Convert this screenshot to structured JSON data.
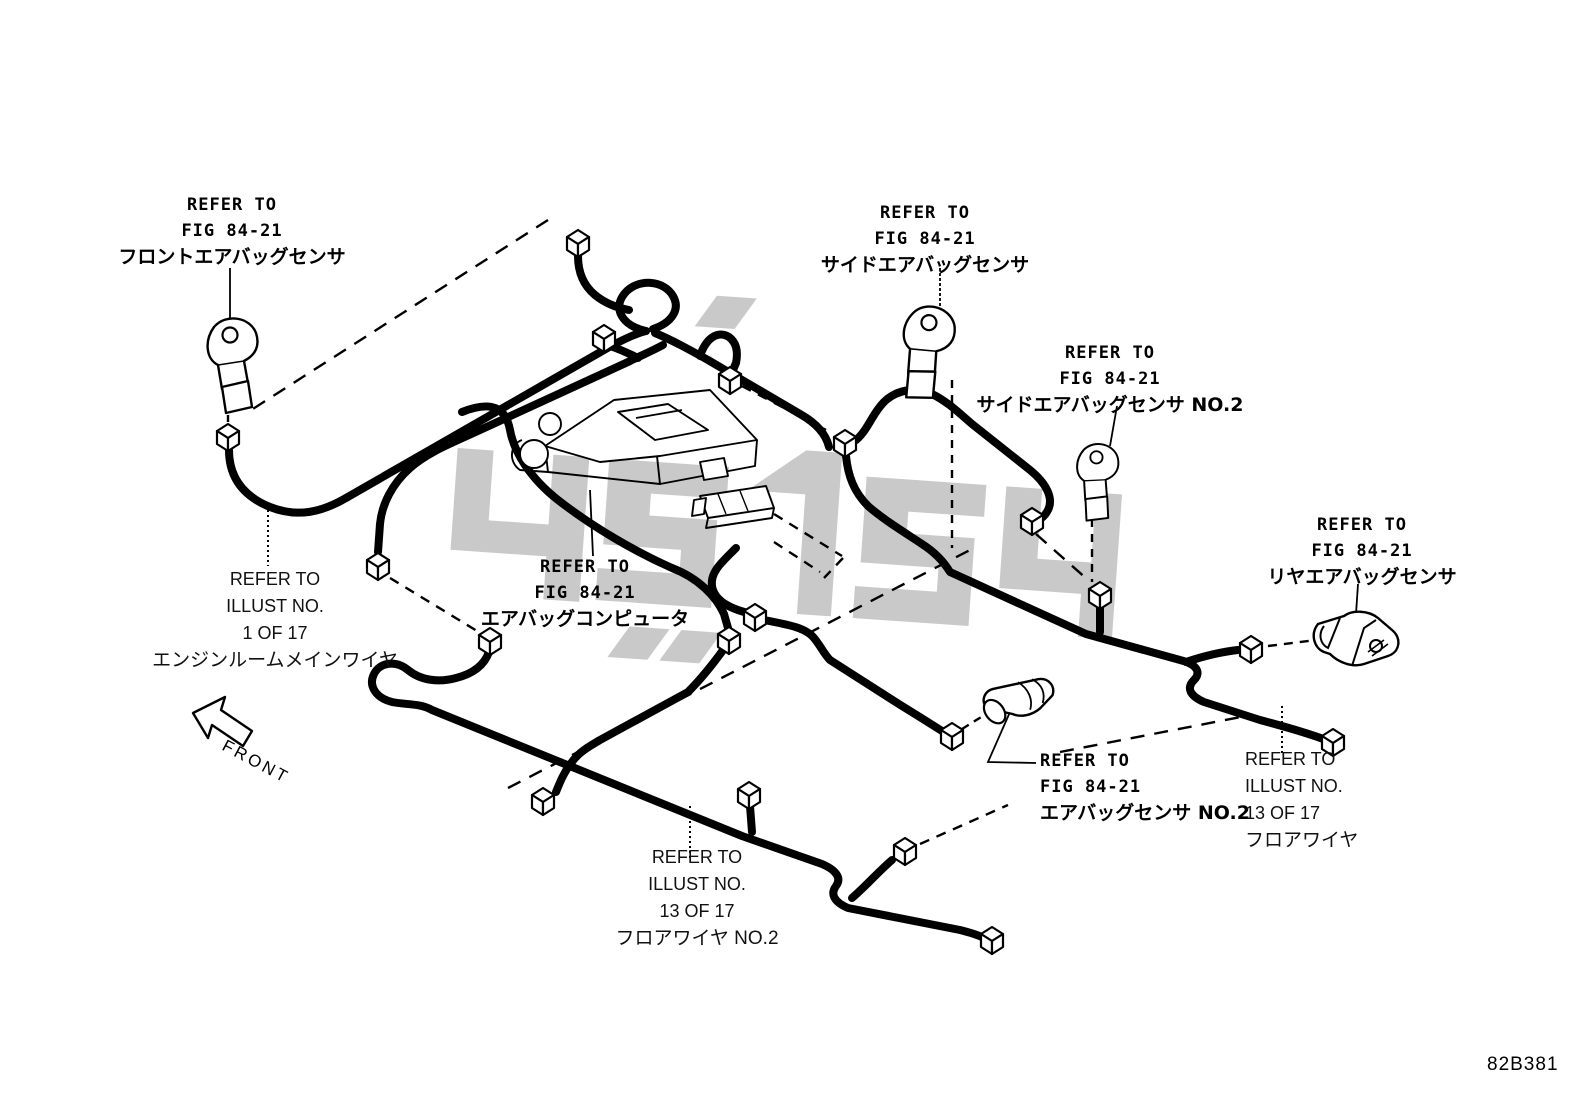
{
  "figure_code": "82B381",
  "front_arrow_label": "FRONT",
  "colors": {
    "line": "#000000",
    "watermark": "#c9c9c9",
    "background": "#ffffff"
  },
  "labels": {
    "front_airbag_sensor": {
      "lines": [
        "REFER TO",
        "FIG 84-21",
        "フロントエアバッグセンサ"
      ]
    },
    "side_airbag_sensor": {
      "lines": [
        "REFER TO",
        "FIG 84-21",
        "サイドエアバッグセンサ"
      ]
    },
    "side_airbag_sensor_no2": {
      "lines": [
        "REFER TO",
        "FIG 84-21",
        "サイドエアバッグセンサ NO.2"
      ]
    },
    "rear_airbag_sensor": {
      "lines": [
        "REFER TO",
        "FIG 84-21",
        "リヤエアバッグセンサ"
      ]
    },
    "airbag_computer": {
      "lines": [
        "REFER TO",
        "FIG 84-21",
        "エアバッグコンピュータ"
      ]
    },
    "airbag_sensor_no2": {
      "lines": [
        "REFER TO",
        "FIG 84-21",
        "エアバッグセンサ NO.2"
      ]
    },
    "engine_room_main_wire": {
      "lines": [
        "REFER TO",
        "ILLUST NO.",
        "1 OF 17",
        "エンジンルームメインワイヤ"
      ]
    },
    "floor_wire_no2": {
      "lines": [
        "REFER TO",
        "ILLUST NO.",
        "13 OF 17",
        "フロアワイヤ NO.2"
      ]
    },
    "floor_wire": {
      "lines": [
        "REFER TO",
        "ILLUST NO.",
        "13 OF 17",
        "フロアワイヤ"
      ]
    }
  }
}
